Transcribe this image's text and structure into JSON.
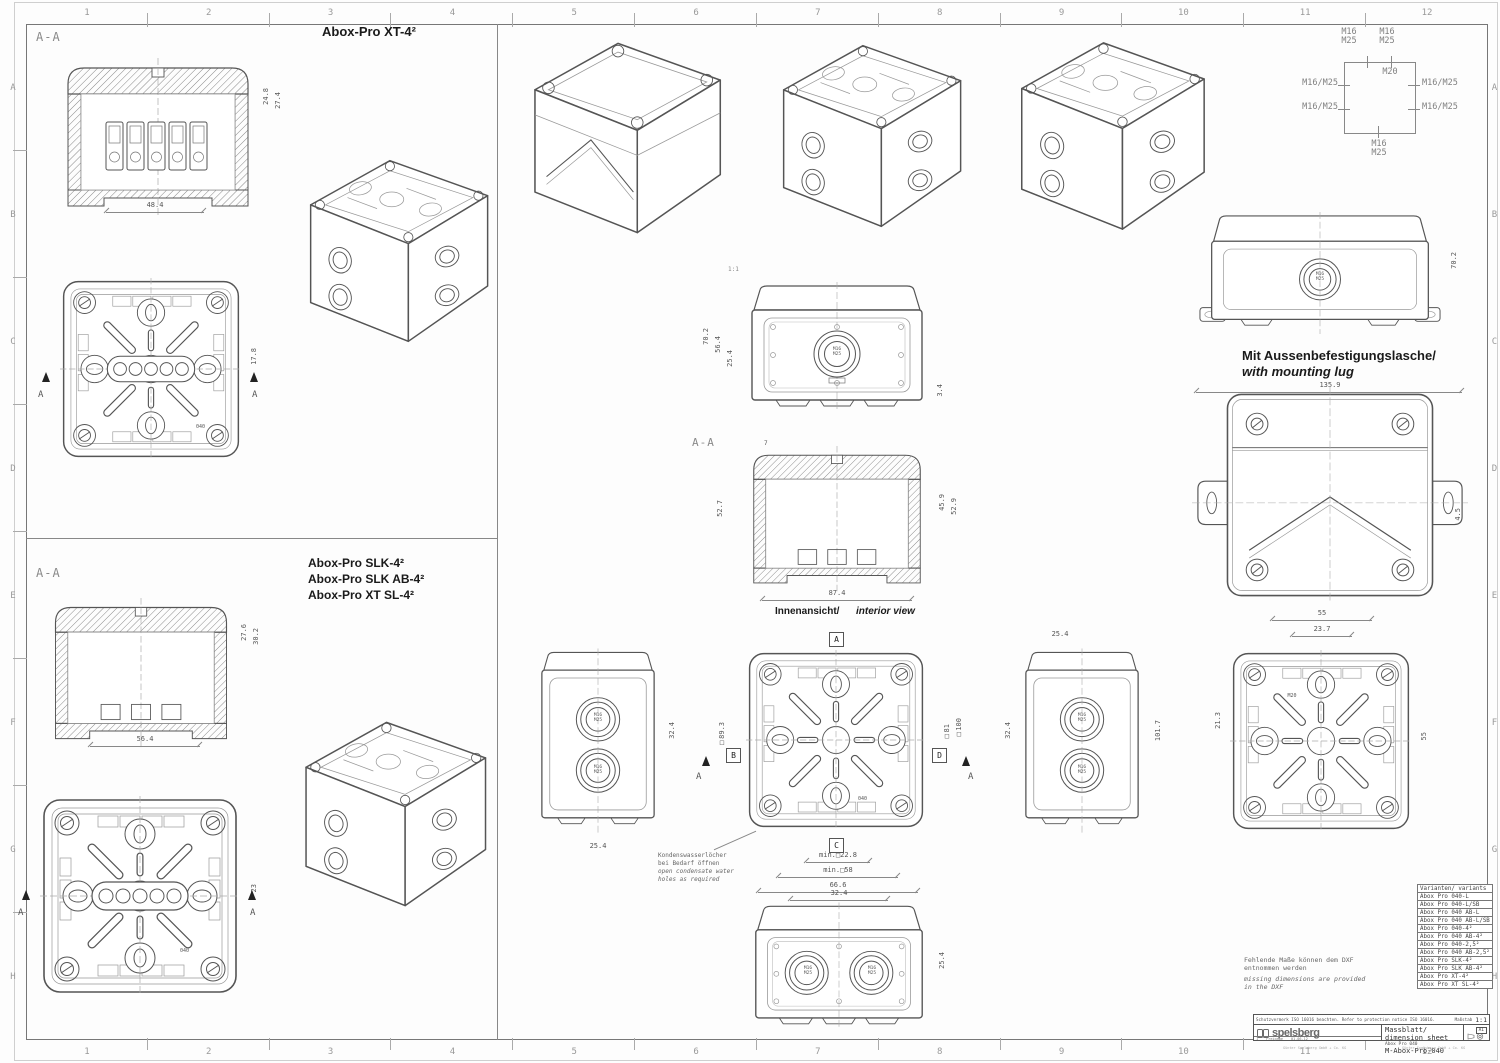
{
  "frame": {
    "cols": [
      "1",
      "2",
      "3",
      "4",
      "5",
      "6",
      "7",
      "8",
      "9",
      "10",
      "11",
      "12"
    ],
    "rows": [
      "A",
      "B",
      "C",
      "D",
      "E",
      "F",
      "G",
      "H"
    ]
  },
  "labels": {
    "aa": "A-A",
    "title_xt": "Abox-Pro XT-4²",
    "slk1": "Abox-Pro SLK-4²",
    "slk2": "Abox-Pro SLK AB-4²",
    "slk3": "Abox-Pro XT SL-4²",
    "scale": "1:1",
    "interior_de": "Innenansicht/",
    "interior_en": "interior view",
    "lug_de": "Mit Aussenbefestigungslasche/",
    "lug_en": "with mounting lug"
  },
  "notes": {
    "kondens_de": "Kondenswasserlöcher\nbei Bedarf öffnen",
    "kondens_en": "open condensate water\nholes as required",
    "missing_de": "Fehlende Maße können dem DXF\nentnommen werden",
    "missing_en": "missing dimensions are provided\nin the DXF"
  },
  "mdia": {
    "t1": "M16\nM25",
    "t2": "M16\nM25",
    "l1": "M16/M25",
    "l2": "M16/M25",
    "r1": "M16/M25",
    "r2": "M16/M25",
    "m20": "M20",
    "b": "M16\nM25"
  },
  "marks": {
    "a": "A",
    "b": "B",
    "c": "C",
    "d": "D",
    "cut": "A",
    "code": "040",
    "m1625": "M16\nM25",
    "m20": "M20"
  },
  "dims": {
    "xt_sec_h1": "24.8",
    "xt_sec_h2": "27.4",
    "xt_sec_w": "48.4",
    "xt_top_r": "17.8",
    "slk_sec_h1": "27.6",
    "slk_sec_h2": "30.2",
    "slk_sec_w": "56.4",
    "slk_top_r": "23",
    "front_h1": "70.2",
    "front_h2": "56.4",
    "front_h3": "25.4",
    "front_r": "3.4",
    "sec_t": "7",
    "sec_l": "52.7",
    "sec_r1": "45.9",
    "sec_r2": "52.9",
    "sec_w": "87.4",
    "int_l": "□89.3",
    "int_r1": "□81",
    "int_r2": "□100",
    "int_b1": "min.□22.8",
    "int_b2": "min.□58",
    "int_b3": "66.6",
    "side_l_v": "32.4",
    "side_l_b": "25.4",
    "side_r_t": "25.4",
    "side_r_l": "32.4",
    "side_r_r": "101.7",
    "bot_t": "32.4",
    "bot_r": "25.4",
    "int2_t1": "55",
    "int2_t2": "23.7",
    "int2_l": "21.3",
    "int2_r": "55",
    "lug_w1": "135.9",
    "lug_w2": "118",
    "lug_r": "4.5",
    "lugside_r": "70.2"
  },
  "variants": {
    "header": "Varianten/ variants",
    "rows": [
      "Abox Pro 040-L",
      "Abox Pro 040-L/SB",
      "Abox Pro 040 AB-L",
      "Abox Pro 040 AB-L/SB",
      "Abox Pro 040-4²",
      "Abox Pro 040 AB-4²",
      "Abox Pro 040-2,5²",
      "Abox Pro 040 AB-2,5²",
      "Abox Pro SLK-4²",
      "Abox Pro SLK AB-4²",
      "Abox Pro XT-4²",
      "Abox Pro XT SL-4²"
    ]
  },
  "tb": {
    "protection": "Schutzvermerk ISO 16016 beachten. Refer to protection notice ISO 16016.",
    "scale_label": "Maßstab",
    "scale_value": "1:1",
    "brand": "spelsberg",
    "sheet_title": "Massblatt/ dimension sheet",
    "product": "Abox Pro 040",
    "doc_number": "M-Abox-Pro-040",
    "format": "A1",
    "rev": "1",
    "rev_label": "Freigabe",
    "rev_date": "01.06.12",
    "footer_left": "Günter Spelsberg GmbH + Co. KG",
    "footer_right": "Günter Spelsberg GmbH + Co. KG"
  }
}
